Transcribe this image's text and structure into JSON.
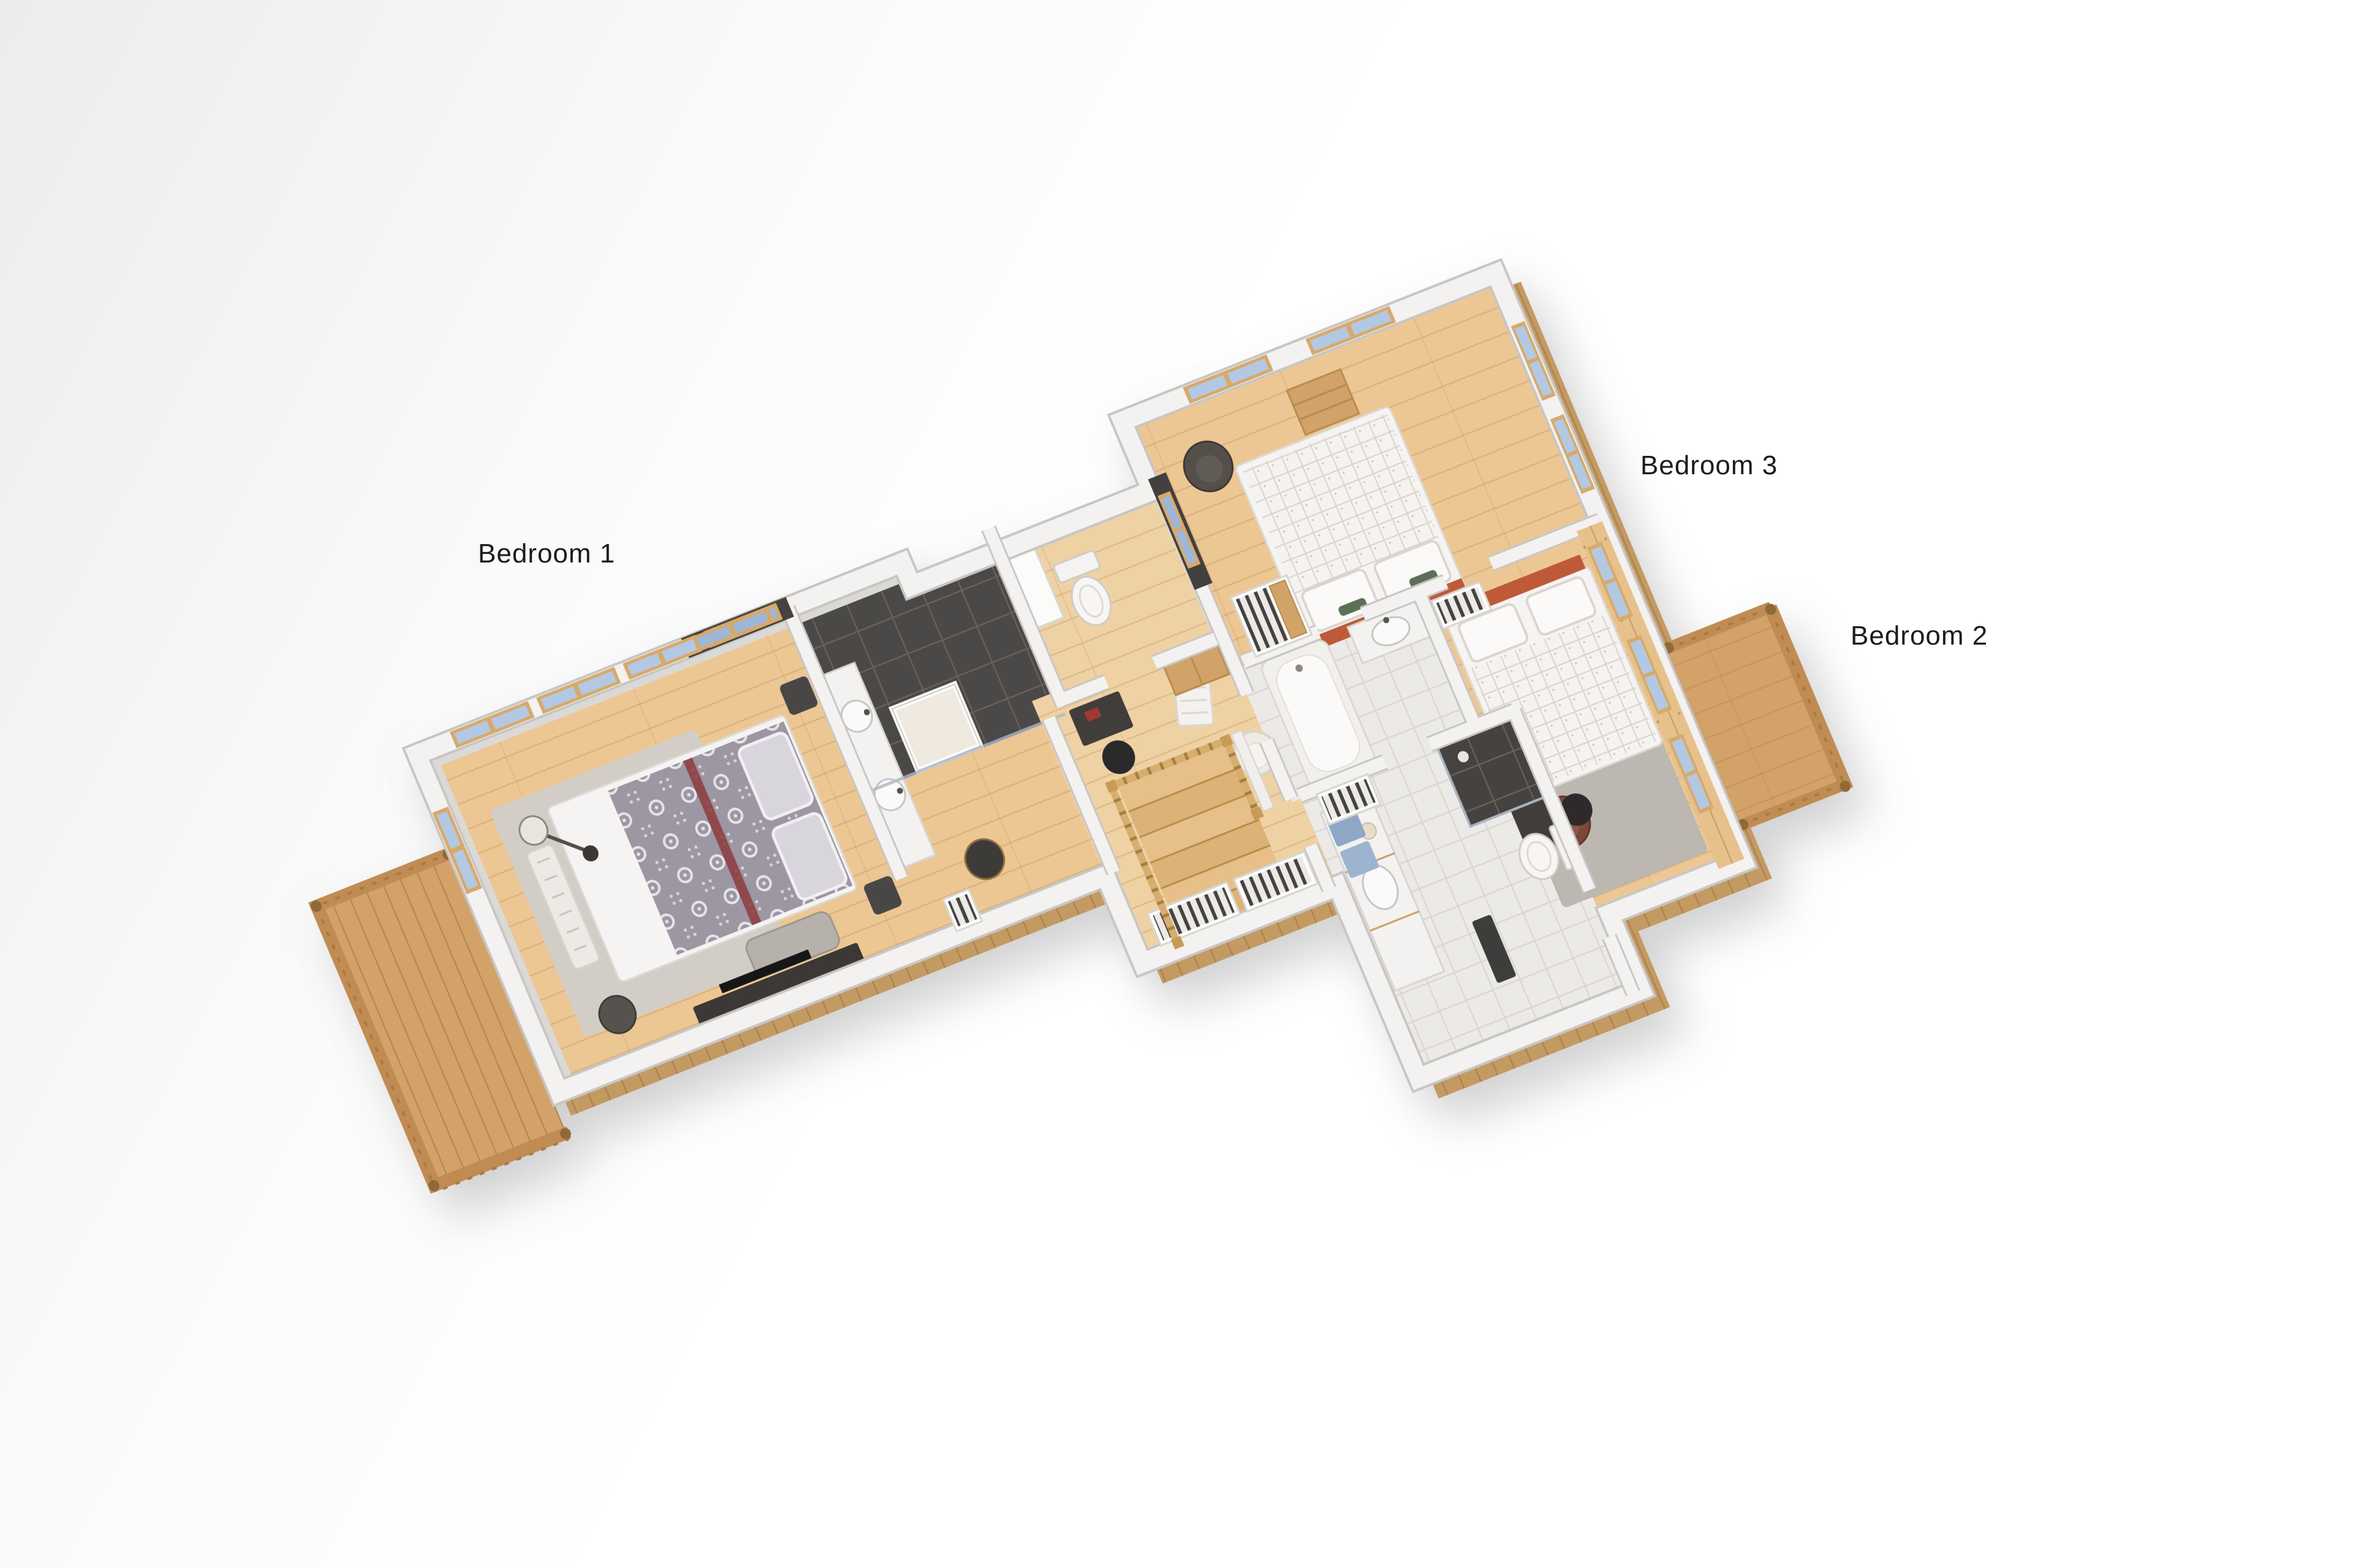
{
  "labels": {
    "bedroom1": "Bedroom 1",
    "bedroom2": "Bedroom 2",
    "bedroom3": "Bedroom 3"
  },
  "palette": {
    "background": "#ffffff",
    "wall_top": "#f3f2f1",
    "wall_edge": "#c8c6c4",
    "wood_floor": "#ecc794",
    "hall_floor": "#efd2a3",
    "dark_tile": "#4b4846",
    "white_tile": "#eceae7",
    "balcony_wood": "#d3a268",
    "railing_wood": "#c08c52",
    "cladding_wood": "#c49a63",
    "window_frame": "#d8a967",
    "window_glass": "#b3c8e2",
    "gray_duvet": "#9d96a3",
    "white_duvet": "#f5f3f0",
    "headboard_accent": "#bf5a38",
    "runner_accent": "#8d3c40",
    "rug_light": "#d2cdc7",
    "rug_gray": "#bcb7b0",
    "armchair_dark": "#54504a",
    "armchair_brown": "#7b4a38",
    "stripe_dark": "#45433f",
    "label_text": "#1c1c1c"
  }
}
